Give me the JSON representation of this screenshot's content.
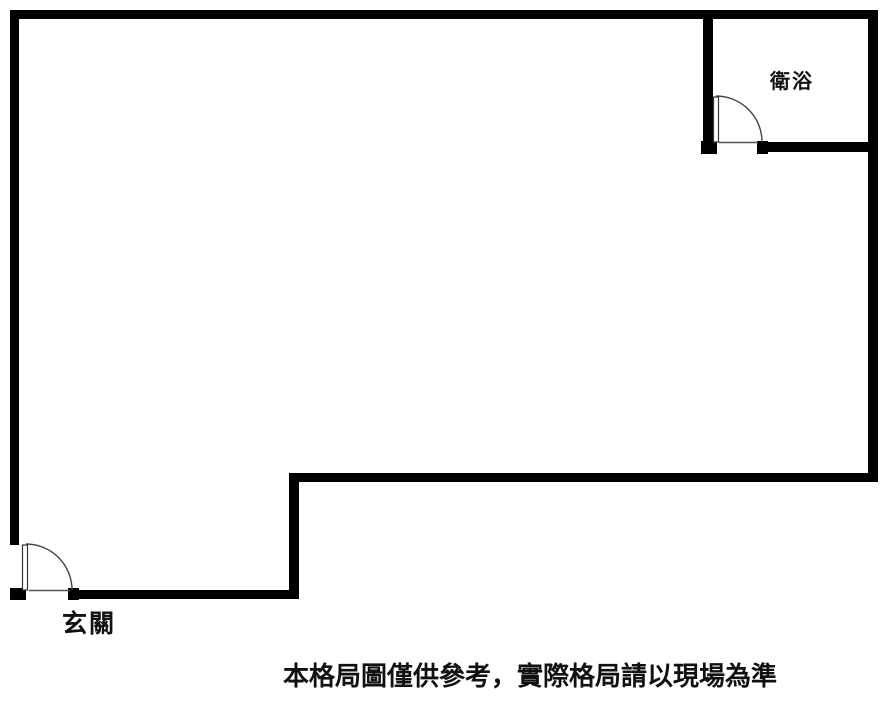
{
  "floorplan": {
    "title": "apartment-floor-plan",
    "labels": {
      "bathroom": "衛浴",
      "entrance": "玄關"
    },
    "disclaimer": "本格局圖僅供參考，實際格局請以現場為準",
    "rooms": [
      {
        "name": "main-room",
        "label": ""
      },
      {
        "name": "bathroom",
        "label": "衛浴"
      }
    ],
    "doors": [
      {
        "name": "entrance-door",
        "location": "bottom-left",
        "swing": "quarter-arc"
      },
      {
        "name": "bathroom-door",
        "location": "bathroom-bottom-wall",
        "swing": "quarter-arc"
      }
    ],
    "colors": {
      "wall": "#000000",
      "background": "#ffffff",
      "door_line": "#444444",
      "text": "#111111"
    }
  }
}
